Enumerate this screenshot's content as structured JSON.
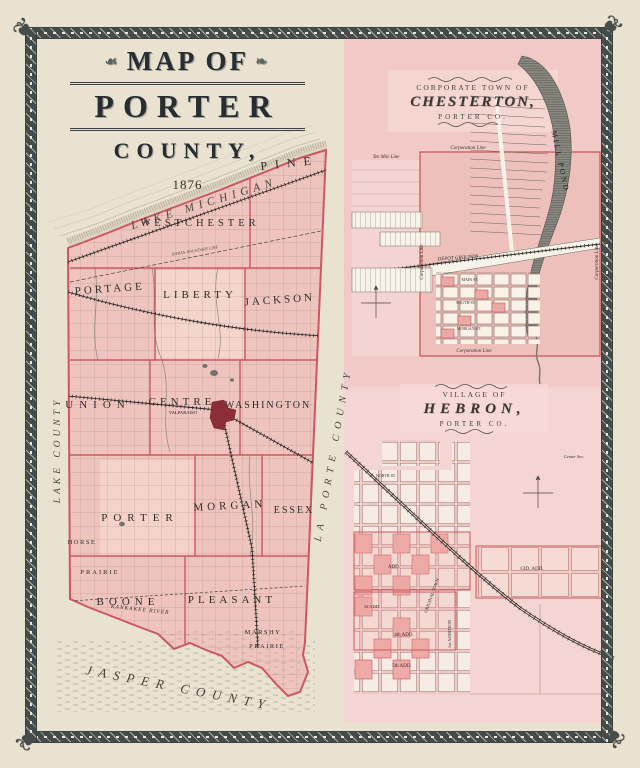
{
  "title": {
    "kicker": "MAP OF",
    "name": "PORTER",
    "suffix": "COUNTY,",
    "year": "1876"
  },
  "main_map": {
    "lake_michigan": "LAKE MICHIGAN",
    "lake_county": "LAKE COUNTY",
    "la_porte_county": "LA PORTE COUNTY",
    "jasper_county": "JASPER COUNTY",
    "townships": {
      "pine": "PINE",
      "westchester": "WESTCHESTER",
      "portage": "PORTAGE",
      "liberty": "LIBERTY",
      "jackson": "JACKSON",
      "union": "UNION",
      "centre": "CENTRE",
      "washington": "WASHINGTON",
      "porter": "PORTER",
      "morgan": "MORGAN",
      "essex": "ESSEX",
      "boone": "BOONE",
      "pleasant": "PLEASANT"
    },
    "features": {
      "valparaiso": "VALPARAISO",
      "horse": "HORSE",
      "prairie": "PRAIRIE",
      "marshy": "MARSHY",
      "marshy_prairie": "PRAIRIE",
      "kankakee_river": "KANKAKEE RIVER",
      "indian_boundary": "INDIAN BOUNDARY LINE"
    }
  },
  "chesterton": {
    "kicker": "CORPORATE TOWN OF",
    "name": "CHESTERTON,",
    "subtitle": "PORTER CO.",
    "labels": {
      "corporation_line_top": "Corporation Line",
      "corporation_line_bottom": "Corporation Line",
      "corporation_line_left": "Corporation Line",
      "corporation_line_right": "Corporation Line",
      "ten_mile_line": "Ten Mile Line",
      "depot_grounds": "DEPOT GROUNDS",
      "mill_pond": "MILL POND",
      "main_st": "MAIN ST.",
      "south_st": "SOUTH ST.",
      "morgan_st": "MORGAN ST."
    }
  },
  "hebron": {
    "kicker": "VILLAGE OF",
    "name": "HEBRON,",
    "subtitle": "PORTER CO.",
    "labels": {
      "center_sec": "Center Sec.",
      "north_st": "NORTH ST.",
      "original_town": "ORIGINAL TOWN",
      "first_addition": "1st ADDITION",
      "third_add": "3d ADD.",
      "fourth_add": "4th ADD.",
      "fifth_add": "5th ADD.",
      "gid_add": "GID. ADD.",
      "add": "ADD."
    }
  },
  "colors": {
    "page": "#e9e2d1",
    "panel_pink": "#f2cdc9",
    "county_pink": "#efc4bf",
    "boundary_red": "#cd5660",
    "frame": "#4a504d",
    "ink": "#2f2c28",
    "city_red": "#8c2e37"
  }
}
